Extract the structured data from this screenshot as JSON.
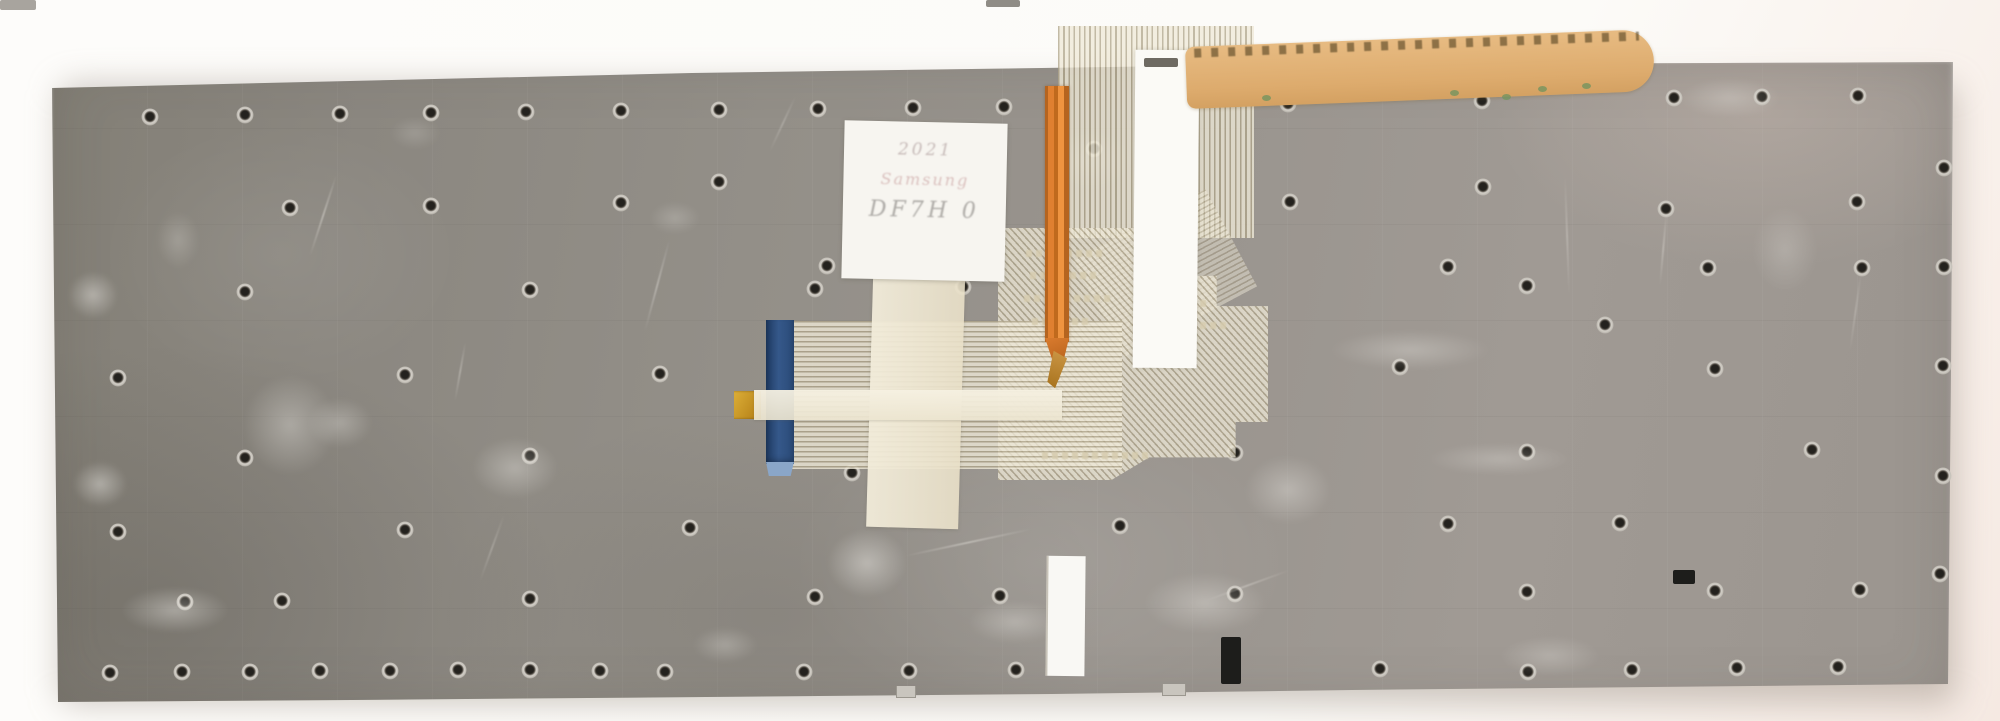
{
  "photo": {
    "description": "Rear metal backplate of a laptop keyboard with screw holes, flexible printed ribbon cables, a blue FFC connector stiffener, an orange flex cable, masking-tape strips, a tan kapton tape strip and a handwritten white sticker"
  },
  "label": {
    "line1": "2021",
    "line2": "Samsung",
    "line3": "DF7H 0"
  },
  "colors": {
    "background": "#fcfbf8",
    "background_tint_right": "#f5e9e2",
    "plate_gray": "#938f88",
    "plate_gray_dark": "#837f76",
    "plate_gray_light": "#a09a94",
    "hole_center": "#24221e",
    "hole_ring": "#d3cfc8",
    "membrane_beige": "#e7dfca",
    "trace_line": "#94886a",
    "connector_blue": "#35588a",
    "connector_tip_blue": "#8aa6c8",
    "gold_tab": "#c8951f",
    "orange_cable": "#e08030",
    "kapton_tape_tan": "#ddab6d",
    "masking_tape_cream": "#efe8d4",
    "white_tape": "#fbfaf6",
    "sticker_white": "#f7f5f0",
    "slot_black": "#1d1d1b",
    "green_speck": "#74945f"
  },
  "plate": {
    "holes": [
      [
        150,
        117
      ],
      [
        245,
        115
      ],
      [
        340,
        114
      ],
      [
        431,
        113
      ],
      [
        526,
        112
      ],
      [
        621,
        111
      ],
      [
        719,
        110
      ],
      [
        818,
        109
      ],
      [
        913,
        108
      ],
      [
        1004,
        107
      ],
      [
        1288,
        104
      ],
      [
        1482,
        101
      ],
      [
        1674,
        98
      ],
      [
        1762,
        97
      ],
      [
        1858,
        96
      ],
      [
        290,
        208
      ],
      [
        431,
        206
      ],
      [
        621,
        203
      ],
      [
        719,
        182
      ],
      [
        928,
        178
      ],
      [
        1094,
        149
      ],
      [
        1290,
        202
      ],
      [
        1483,
        187
      ],
      [
        1666,
        209
      ],
      [
        1857,
        202
      ],
      [
        1944,
        168
      ],
      [
        245,
        292
      ],
      [
        530,
        290
      ],
      [
        815,
        289
      ],
      [
        827,
        266
      ],
      [
        963,
        287
      ],
      [
        1448,
        267
      ],
      [
        1527,
        286
      ],
      [
        1708,
        268
      ],
      [
        1862,
        268
      ],
      [
        1944,
        267
      ],
      [
        118,
        378
      ],
      [
        405,
        375
      ],
      [
        660,
        374
      ],
      [
        1400,
        367
      ],
      [
        1605,
        325
      ],
      [
        1715,
        369
      ],
      [
        1943,
        366
      ],
      [
        245,
        458
      ],
      [
        530,
        456
      ],
      [
        852,
        473
      ],
      [
        1088,
        455
      ],
      [
        1235,
        453
      ],
      [
        1527,
        452
      ],
      [
        1812,
        450
      ],
      [
        1943,
        476
      ],
      [
        118,
        532
      ],
      [
        405,
        530
      ],
      [
        690,
        528
      ],
      [
        1120,
        526
      ],
      [
        1448,
        524
      ],
      [
        1620,
        523
      ],
      [
        1940,
        574
      ],
      [
        185,
        602
      ],
      [
        282,
        601
      ],
      [
        530,
        599
      ],
      [
        815,
        597
      ],
      [
        1000,
        596
      ],
      [
        1235,
        594
      ],
      [
        1527,
        592
      ],
      [
        1715,
        591
      ],
      [
        1860,
        590
      ],
      [
        110,
        673
      ],
      [
        182,
        672
      ],
      [
        250,
        672
      ],
      [
        320,
        671
      ],
      [
        390,
        671
      ],
      [
        458,
        670
      ],
      [
        530,
        670
      ],
      [
        600,
        671
      ],
      [
        665,
        672
      ],
      [
        804,
        672
      ],
      [
        909,
        671
      ],
      [
        1016,
        670
      ],
      [
        1380,
        669
      ],
      [
        1528,
        672
      ],
      [
        1632,
        670
      ],
      [
        1737,
        668
      ],
      [
        1838,
        667
      ]
    ],
    "smudges": [
      [
        58,
        262,
        70,
        66,
        0.5
      ],
      [
        62,
        452,
        76,
        64,
        0.5
      ],
      [
        100,
        578,
        150,
        64,
        0.45
      ],
      [
        225,
        355,
        130,
        140,
        0.4
      ],
      [
        295,
        388,
        90,
        70,
        0.35
      ],
      [
        455,
        425,
        120,
        85,
        0.4
      ],
      [
        640,
        195,
        70,
        45,
        0.25
      ],
      [
        812,
        515,
        110,
        95,
        0.5
      ],
      [
        1228,
        442,
        120,
        95,
        0.4
      ],
      [
        1120,
        560,
        170,
        85,
        0.4
      ],
      [
        1035,
        120,
        110,
        80,
        0.3
      ],
      [
        1660,
        70,
        140,
        55,
        0.3
      ],
      [
        1480,
        628,
        140,
        55,
        0.3
      ],
      [
        380,
        110,
        70,
        45,
        0.2
      ],
      [
        950,
        592,
        130,
        60,
        0.35
      ],
      [
        1300,
        322,
        220,
        55,
        0.35
      ],
      [
        1400,
        436,
        200,
        45,
        0.3
      ],
      [
        680,
        620,
        90,
        50,
        0.3
      ],
      [
        1740,
        190,
        90,
        120,
        0.25
      ],
      [
        148,
        200,
        60,
        80,
        0.25
      ]
    ],
    "scratches": [
      [
        310,
        255,
        85,
        -72,
        0.5
      ],
      [
        455,
        400,
        60,
        -80,
        0.4
      ],
      [
        645,
        330,
        95,
        -75,
        0.45
      ],
      [
        905,
        555,
        130,
        -12,
        0.5
      ],
      [
        1660,
        285,
        75,
        -85,
        0.4
      ],
      [
        1565,
        175,
        120,
        88,
        0.35
      ],
      [
        770,
        150,
        60,
        -65,
        0.3
      ],
      [
        1205,
        600,
        90,
        -20,
        0.4
      ],
      [
        480,
        580,
        70,
        -70,
        0.3
      ],
      [
        1850,
        350,
        80,
        -82,
        0.3
      ]
    ],
    "prints": [
      [
        1026,
        250,
        78
      ],
      [
        1030,
        272,
        66
      ],
      [
        1024,
        295,
        88
      ],
      [
        1032,
        318,
        58
      ],
      [
        1042,
        452,
        108
      ],
      [
        1150,
        300,
        60
      ],
      [
        1160,
        322,
        70
      ]
    ]
  },
  "marks": {
    "green_specks": [
      [
        1538,
        86
      ],
      [
        1502,
        94
      ],
      [
        1262,
        95
      ],
      [
        1450,
        90
      ],
      [
        1582,
        83
      ]
    ],
    "black_slots": [
      [
        1221,
        637,
        20,
        47
      ],
      [
        1673,
        570,
        22,
        14
      ]
    ],
    "metal_tabs": [
      [
        896,
        686,
        18,
        11
      ],
      [
        1162,
        684,
        22,
        11
      ]
    ],
    "slivers": [
      [
        0,
        0,
        36,
        10,
        "#a8a49e"
      ],
      [
        986,
        0,
        34,
        7,
        "#8f8c86"
      ],
      [
        1144,
        58,
        34,
        9,
        "#6e6a62"
      ]
    ]
  }
}
